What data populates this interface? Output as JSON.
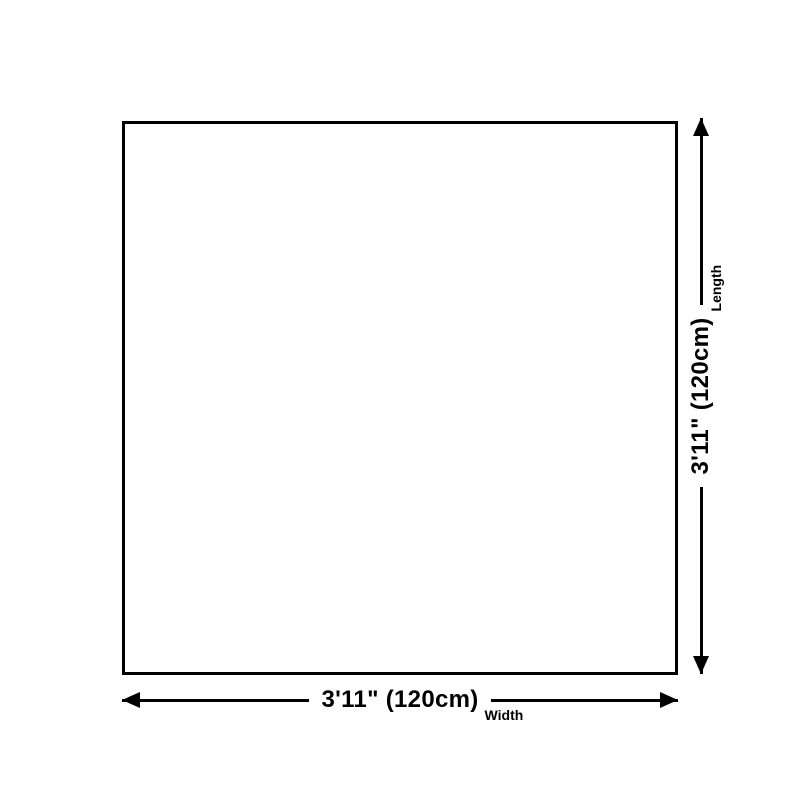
{
  "diagram": {
    "background_color": "#ffffff",
    "outline_color": "#000000",
    "shape": "rectangle",
    "width_dimension": {
      "value": "3'11\" (120cm)",
      "label": "Width"
    },
    "length_dimension": {
      "value": "3'11\" (120cm)",
      "label": "Length"
    }
  }
}
